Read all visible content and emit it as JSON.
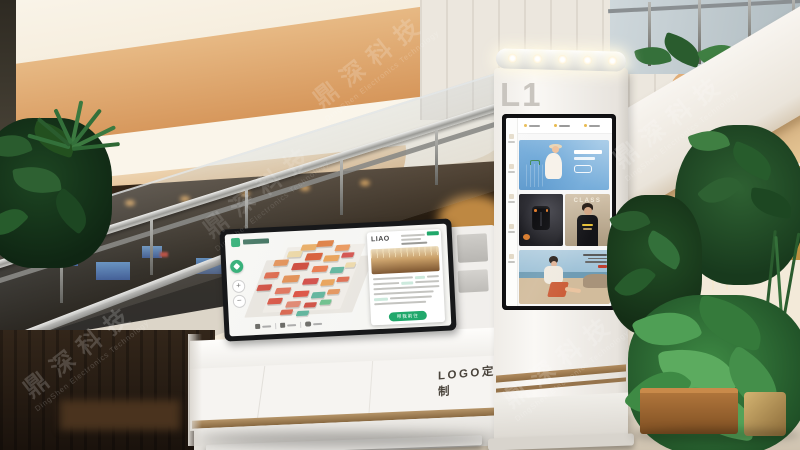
{
  "watermark": {
    "cn": "鼎深科技",
    "en": "DingShen Electronics Technology"
  },
  "tower": {
    "floor_label": "L1",
    "screen": {
      "card_brand_text": "CLASS"
    }
  },
  "kiosk": {
    "body_label": "LOGO定制",
    "screen": {
      "zoom_in": "+",
      "zoom_out": "−",
      "panel": {
        "brand": "LIAO",
        "cta_label": "带我前往"
      }
    }
  },
  "colors": {
    "accent_green": "#21a86b",
    "bronze_stripe": "#a8855c",
    "map_orange": "#e2935a",
    "map_red": "#cf4f42",
    "map_teal": "#5fb49c",
    "banner_blue": "#6ea8d8"
  }
}
